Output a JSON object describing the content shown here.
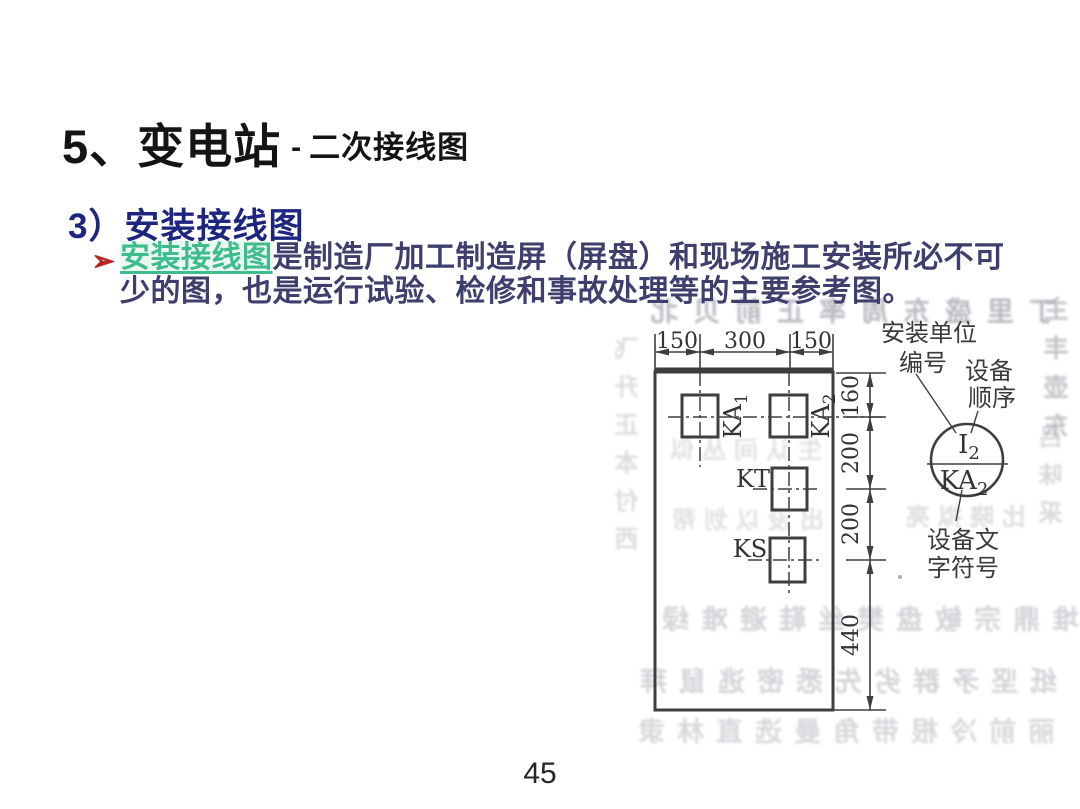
{
  "slide": {
    "title": {
      "main": "5、变电站",
      "dash": "-",
      "subtitle": "二次接线图"
    },
    "heading": "3）安装接线图",
    "bullet": {
      "marker": "➢",
      "highlight": "安装接线图",
      "line1_rest": "是制造厂加工制造屏（屏盘）和现场施工安装所必不可",
      "line2": "少的图，也是运行试验、检修和事故处理等的主要参考图。"
    },
    "page_number": "45"
  },
  "figure": {
    "dims": {
      "top": [
        "150",
        "300",
        "150"
      ],
      "side": [
        "160",
        "200",
        "200",
        "440"
      ]
    },
    "components": {
      "ka1": {
        "base": "KA",
        "sub": "1"
      },
      "ka2": {
        "base": "KA",
        "sub": "2"
      },
      "kt": "KT",
      "ks": "KS"
    },
    "circle_symbol": {
      "top_base": "I",
      "top_sub": "2",
      "bottom_base": "KA",
      "bottom_sub": "2"
    },
    "callouts": {
      "unit_l1": "安装单位",
      "unit_l2": "编号",
      "order_l1": "设备",
      "order_l2": "顺序",
      "code_l1": "设备文",
      "code_l2": "字符号"
    }
  },
  "colors": {
    "heading_blue": "#1e2580",
    "body_navy": "#3f3f6d",
    "highlight_green": "#3fbc8e",
    "bullet_red": "#b92420",
    "line_gray": "#3e3e3e"
  },
  "ghost_text": {
    "top": "丁里盛东周率正前贝北",
    "left_col": "飞升正本付西",
    "right_col_a": "主丰壶东",
    "right_col_b": "吕味采",
    "panel_a": "生认间丛似",
    "panel_b": "出没以划帮",
    "mid": "比晓拟亮",
    "row_a": "堆鼎宗敏盘樊丝鞋避难绿",
    "row_b": "纸坚矛群劣先悉密逃鼠拜",
    "row_c": "丽前冷根带角曼选直林隶"
  }
}
